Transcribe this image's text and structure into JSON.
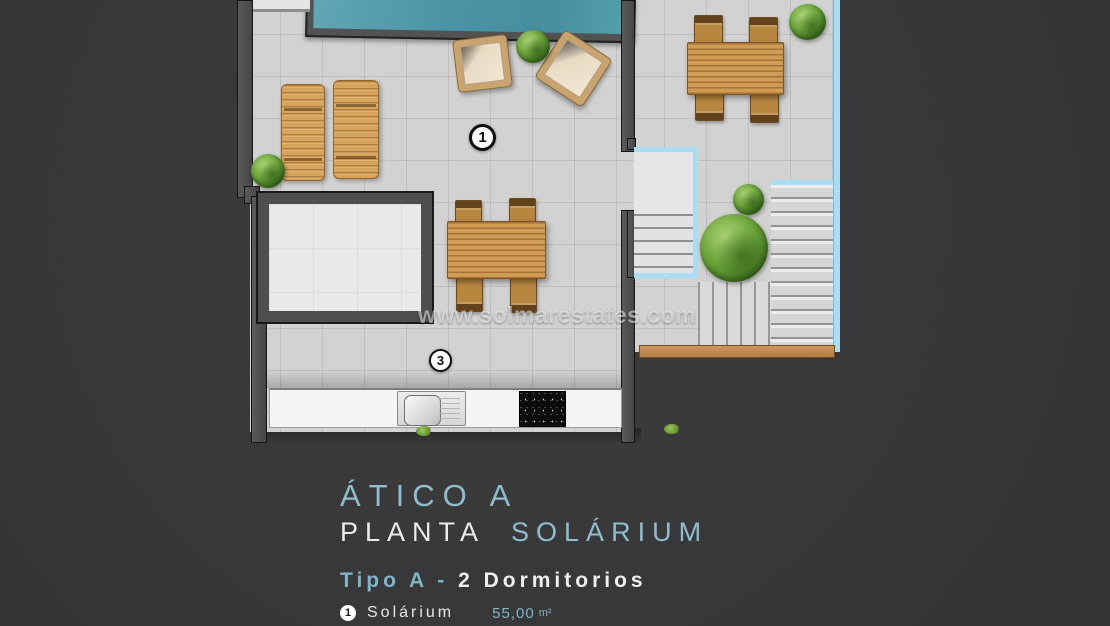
{
  "watermark": "www.solmarestates.com",
  "plan": {
    "markers": {
      "one": "1",
      "three": "3"
    }
  },
  "caption": {
    "title": "ÁTICO A",
    "plan_word": "PLANTA",
    "plan_accent": "SOLÁRIUM",
    "type_accent": "Tipo A -",
    "type_rest": "2 Dormitorios",
    "legend_item": {
      "num": "1",
      "label": "Solárium",
      "value": "55,00",
      "unit": "m²"
    }
  },
  "colors": {
    "background": "#383838",
    "accent_blue": "#8fbdd0",
    "railing_blue": "#aadcf4",
    "pool_teal": "#4a93a4",
    "wood": "#d09b52",
    "tile": "#d2d2d2",
    "text_white": "#ececec"
  }
}
